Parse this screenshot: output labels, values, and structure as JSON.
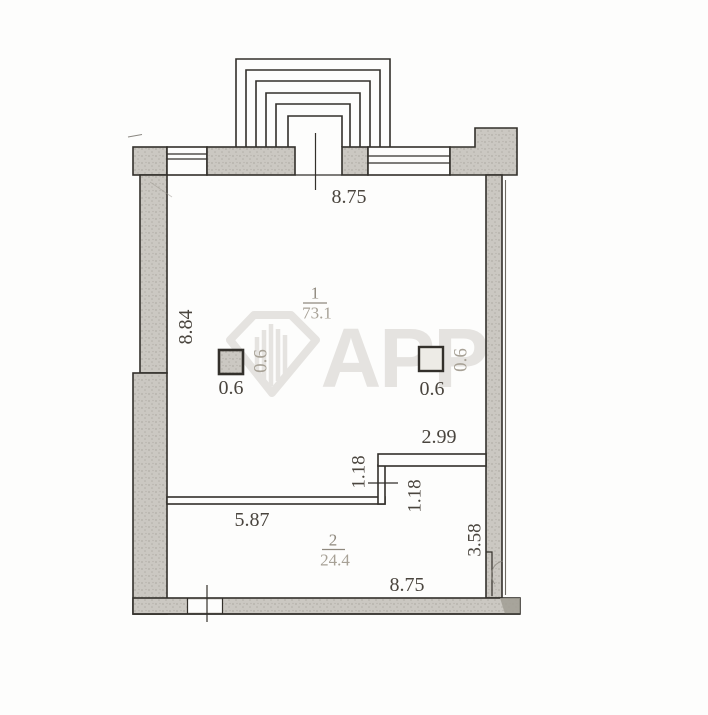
{
  "plan": {
    "watermark": {
      "text": "APP"
    },
    "rooms": [
      {
        "number": "1",
        "area": "73.1"
      },
      {
        "number": "2",
        "area": "24.4"
      }
    ],
    "dimensions": {
      "top_width": "8.75",
      "left_height": "8.84",
      "upper_partition_width": "2.99",
      "jog_height_left": "1.18",
      "jog_height_right": "1.18",
      "lower_partition_width": "5.87",
      "right_lower_height": "3.58",
      "bottom_width": "8.75",
      "column_left_width": "0.6",
      "column_left_depth": "0.6",
      "column_right_width": "0.6",
      "column_right_depth": "0.6"
    },
    "colors": {
      "paper": "#fdfdfc",
      "wall_fill": "#cbc8c2",
      "wall_dots": "#b2afa8",
      "line": "#33302b",
      "dim_text": "#4a453e",
      "room_text": "#8f897e",
      "faded_text": "#a7a196",
      "watermark": "#e5e3e0",
      "shadow": "#a19d94"
    }
  }
}
